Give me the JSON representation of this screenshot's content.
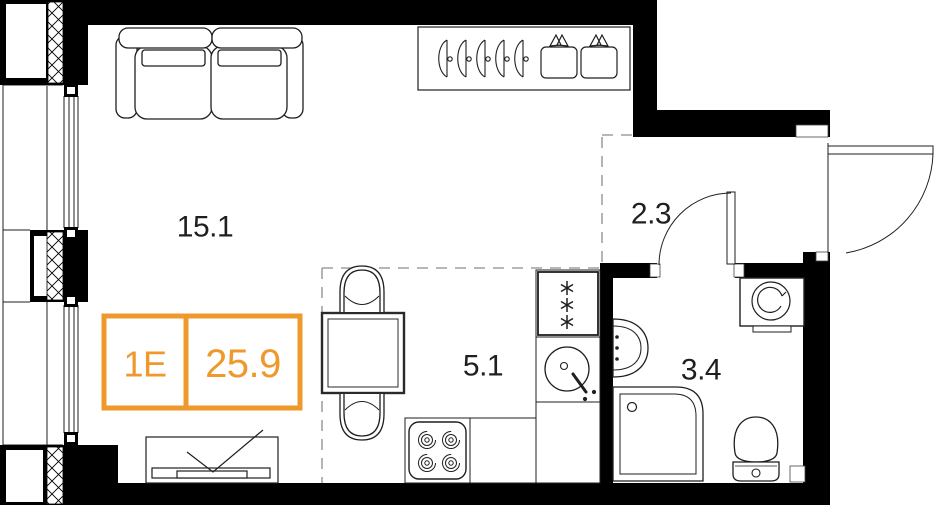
{
  "floor_plan": {
    "unit": {
      "type_label": "1E",
      "area_value": "25.9"
    },
    "rooms": [
      {
        "id": "living-room",
        "area_label": "15.1"
      },
      {
        "id": "hallway",
        "area_label": "2.3"
      },
      {
        "id": "kitchen",
        "area_label": "5.1"
      },
      {
        "id": "bathroom",
        "area_label": "3.4"
      }
    ],
    "icons": [
      "sofa-icon",
      "tv-stand-icon",
      "dish-rack-icon",
      "dining-table-icon",
      "chair-icon",
      "stove-icon",
      "fridge-icon",
      "kitchen-sink-icon",
      "washbasin-icon",
      "shower-icon",
      "toilet-icon",
      "washing-machine-icon",
      "door-swing-icon",
      "window-icon"
    ],
    "colors": {
      "accent_orange": "#EF992D",
      "wall_black": "#000000",
      "line_dark": "#1F1F1F",
      "dash_gray": "#8C8C8C",
      "background": "#FFFFFF"
    }
  }
}
